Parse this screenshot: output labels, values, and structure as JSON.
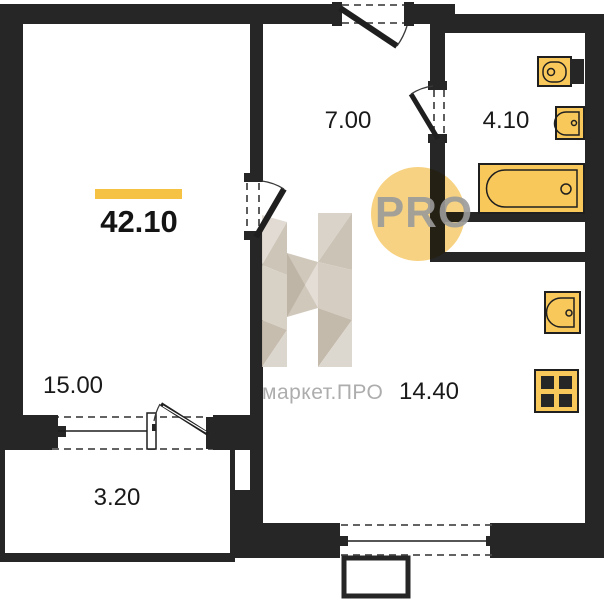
{
  "plan": {
    "total_area": "42.10",
    "rooms": {
      "living": "15.00",
      "balcony": "3.20",
      "hallway": "7.00",
      "bathroom": "4.10",
      "kitchen": "14.40"
    },
    "watermark": {
      "circle_text": "PRO",
      "brand_text": "маркет.ПРО"
    },
    "colors": {
      "wall": "#262626",
      "line": "#1f1f1f",
      "dash": "#4d4d4d",
      "fixture_fill": "#F8C85A",
      "accent_bar": "#F6C244",
      "watermark_circle": "#F7CD74",
      "watermark_gray": "#9B9B9B",
      "brand_text_gray": "#ADADAD"
    }
  }
}
